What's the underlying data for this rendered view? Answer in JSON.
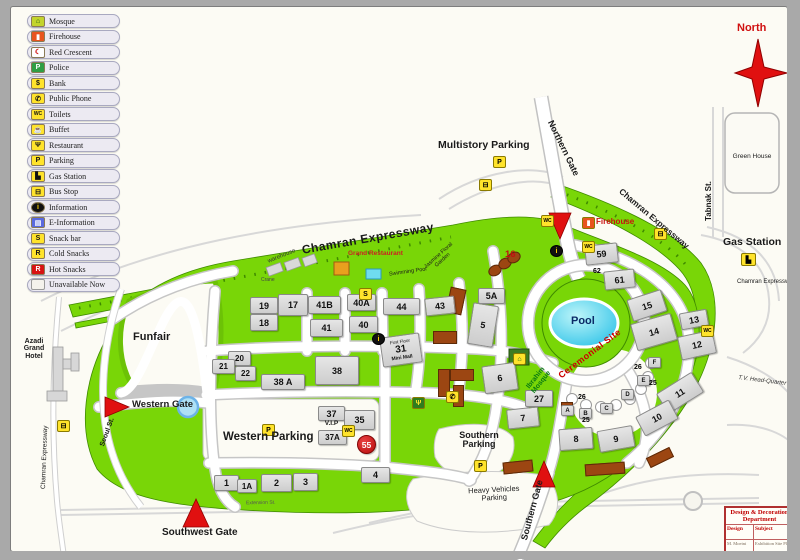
{
  "compass": {
    "north_label": "North"
  },
  "map_labels": {
    "multistory_parking": "Multistory Parking",
    "northern_gate": "Northern Gate",
    "firehouse": "Firehouse",
    "green_house": "Green House",
    "tabnak_st": "Tabnak St.",
    "gas_station": "Gas Station",
    "chamran_expressway": "Chamran Expressway",
    "grand_restaurant": "Grand Restaurant",
    "warehouse": "warehouse",
    "floral_garden": "Jasmine Floral Garden",
    "swimming_pool": "Swimming Pool",
    "crane": "Crane",
    "funfair": "Funfair",
    "azadi_grand_hotel": "Azadi Grand Hotel",
    "western_gate": "Western Gate",
    "western_parking": "Western Parking",
    "southwest_gate": "Southwest Gate",
    "extension_st": "Extension St.",
    "seoul_st": "Seoul St.",
    "southern_parking": "Southern Parking",
    "heavy_vehicles_parking": "Heavy Vehicles Parking",
    "southern_gate": "Southern Gate",
    "pool": "Pool",
    "ceremonial_site": "Ceremonial Site",
    "ibrahim_mosque": "Ibrahim Mosque",
    "tv_headquarter": "T.V. Head-Quarter",
    "first_floor": "First Floor",
    "mini_mall": "Mini Mall",
    "vip": "V.I.P"
  },
  "buildings": {
    "h1": "1",
    "h1a": "1A",
    "h2": "2",
    "h3": "3",
    "h4": "4",
    "h5": "5",
    "h5a": "5A",
    "h6": "6",
    "h7": "7",
    "h8": "8",
    "h9": "9",
    "h10": "10",
    "h11": "11",
    "h12": "12",
    "h13": "13",
    "h14": "14",
    "h15": "15",
    "h16": "16",
    "h17": "17",
    "h18": "18",
    "h19": "19",
    "h20": "20",
    "h21": "21",
    "h22": "22",
    "h25": "25",
    "h26": "26",
    "h27": "27",
    "h31": "31",
    "h35": "35",
    "h37": "37",
    "h37a": "37A",
    "h38": "38",
    "h38a": "38 A",
    "h40": "40",
    "h40a": "40A",
    "h41": "41",
    "h41b": "41B",
    "h43": "43",
    "h44": "44",
    "h55": "55",
    "h59": "59",
    "h61": "61",
    "h62": "62",
    "rA": "A",
    "rB": "B",
    "rC": "C",
    "rD": "D",
    "rE": "E",
    "rF": "F"
  },
  "icons": {
    "parking": "P",
    "bus": "⊟",
    "wc": "WC",
    "info": "i",
    "phone": "✆",
    "restaurant": "Ψ",
    "gas": "▙",
    "mosque": "⌂",
    "firehouse": "▮",
    "snack": "S"
  },
  "legend": {
    "items": [
      {
        "label": "Mosque",
        "glyph": "⌂",
        "icon_style": "background:#c3d42c;color:#0b4f12"
      },
      {
        "label": "Firehouse",
        "glyph": "▮",
        "icon_style": "background:#e8541e;color:#ffffff"
      },
      {
        "label": "Red Crescent",
        "glyph": "☾",
        "icon_style": "background:#ffffff;color:#cc0000"
      },
      {
        "label": "Police",
        "glyph": "P",
        "icon_style": "background:#2f9e44;color:#ffffff"
      },
      {
        "label": "Bank",
        "glyph": "$",
        "icon_style": "background:#ffe32b;color:#111111"
      },
      {
        "label": "Public Phone",
        "glyph": "✆",
        "icon_style": "background:#ffe32b;color:#111111"
      },
      {
        "label": "Toilets",
        "glyph": "WC",
        "icon_style": "background:#ffe32b;color:#111111;font-size:5px"
      },
      {
        "label": "Buffet",
        "glyph": "☕",
        "icon_style": "background:#ffe32b;color:#111111"
      },
      {
        "label": "Restaurant",
        "glyph": "Ψ",
        "icon_style": "background:#ffe32b;color:#111111"
      },
      {
        "label": "Parking",
        "glyph": "P",
        "icon_style": "background:#ffe32b;color:#111111"
      },
      {
        "label": "Gas Station",
        "glyph": "▙",
        "icon_style": "background:#ffe32b;color:#111111"
      },
      {
        "label": "Bus Stop",
        "glyph": "⊟",
        "icon_style": "background:#ffe32b;color:#111111"
      },
      {
        "label": "Information",
        "glyph": "i",
        "icon_style": "background:#111111;color:#ffd400;border-radius:50%"
      },
      {
        "label": "E-Information",
        "glyph": "▤",
        "icon_style": "background:#5a6ae0;color:#ffffff"
      },
      {
        "label": "Snack bar",
        "glyph": "S",
        "icon_style": "background:#ffe32b;color:#111111"
      },
      {
        "label": "Cold Snacks",
        "glyph": "R",
        "icon_style": "background:#ffe32b;color:#111111"
      },
      {
        "label": "Hot Snacks",
        "glyph": "R",
        "icon_style": "background:#d81212;color:#ffffff"
      },
      {
        "label": "Unavailable Now",
        "glyph": "",
        "icon_style": "background:#f4f2ec;color:#f4f2ec;border-color:#9a9a9a"
      }
    ]
  },
  "design_box": {
    "title": "Design & Decoration Department",
    "design_label": "Design",
    "subject_label": "Subject",
    "design_value": "M. Moeini",
    "subject_value": "Exhibition Site Plan"
  },
  "colors": {
    "grass": "#79d607",
    "road": "#ffffff",
    "building": "#d9d9d9",
    "unavailable": "#9c4612",
    "pool": "#2fc3e8",
    "accent_red": "#d01010"
  }
}
